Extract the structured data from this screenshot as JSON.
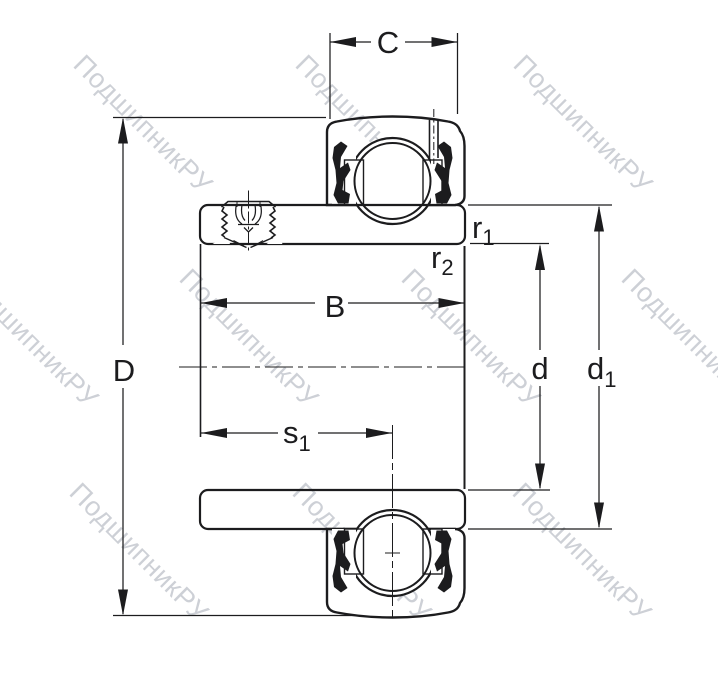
{
  "figure": {
    "watermark_text": "ПодшипникРУ"
  },
  "dimension_labels": {
    "C": {
      "text": "C"
    },
    "D": {
      "text": "D"
    },
    "B": {
      "text": "B"
    },
    "s1": {
      "base": "s",
      "sub": "1"
    },
    "r1": {
      "base": "r",
      "sub": "1"
    },
    "r2": {
      "base": "r",
      "sub": "2"
    },
    "d": {
      "text": "d"
    },
    "d1": {
      "base": "d",
      "sub": "1"
    }
  },
  "colors": {
    "background": "#ffffff",
    "section_fill": "#c6d4e9",
    "outline": "#1c1c1e",
    "watermark": "#c5c8cf"
  }
}
